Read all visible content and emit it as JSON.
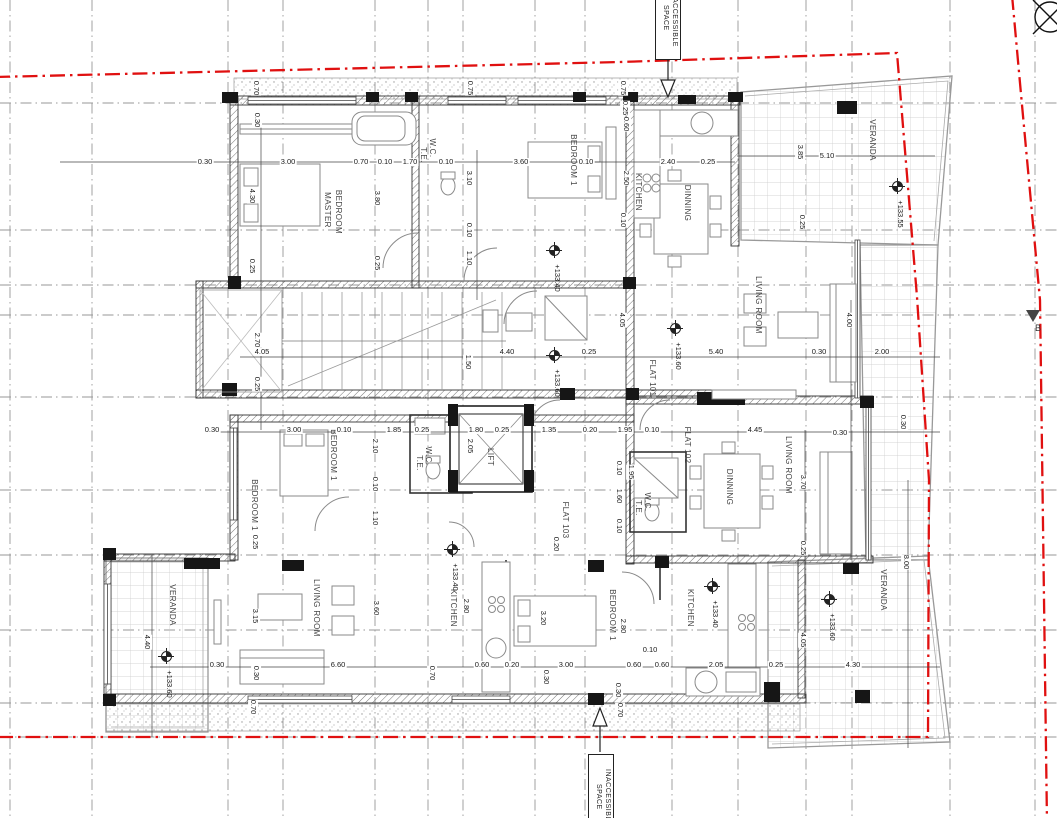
{
  "colors": {
    "boundary": "#e01010",
    "grid": "#979797",
    "ink": "#222222"
  },
  "markers": {
    "section": "B"
  },
  "inaccessible_space": {
    "top": "INACCESSIBLE SPACE",
    "bottom": "INACCESSIBLE SPACE"
  },
  "labels": {
    "rooms": [
      {
        "t": "MASTER",
        "x": 327,
        "y": 210,
        "v": true
      },
      {
        "t": "BEDROOM",
        "x": 338,
        "y": 212,
        "v": true
      },
      {
        "t": "W.C.",
        "x": 432,
        "y": 148,
        "v": true
      },
      {
        "t": "T.E.",
        "x": 423,
        "y": 155,
        "v": true
      },
      {
        "t": "BEDROOM 1",
        "x": 573,
        "y": 160,
        "v": true
      },
      {
        "t": "KITCHEN",
        "x": 638,
        "y": 192,
        "v": true
      },
      {
        "t": "DINNING",
        "x": 687,
        "y": 203,
        "v": true
      },
      {
        "t": "VERANDA",
        "x": 872,
        "y": 140,
        "v": true
      },
      {
        "t": "LIVING ROOM",
        "x": 758,
        "y": 305,
        "v": true
      },
      {
        "t": "LIVING ROOM",
        "x": 788,
        "y": 465,
        "v": true
      },
      {
        "t": "DINNING",
        "x": 729,
        "y": 487,
        "v": true
      },
      {
        "t": "W.C.",
        "x": 647,
        "y": 502,
        "v": true
      },
      {
        "t": "T.E.",
        "x": 638,
        "y": 508,
        "v": true
      },
      {
        "t": "BEDROOM 1",
        "x": 333,
        "y": 455,
        "v": true
      },
      {
        "t": "BEDROOM 1",
        "x": 254,
        "y": 505,
        "v": true
      },
      {
        "t": "W.C.",
        "x": 428,
        "y": 456,
        "v": true
      },
      {
        "t": "T.E.",
        "x": 419,
        "y": 463,
        "v": true
      },
      {
        "t": "LIFT",
        "x": 490,
        "y": 457,
        "v": true
      },
      {
        "t": "LIVING ROOM",
        "x": 316,
        "y": 608,
        "v": true
      },
      {
        "t": "KITCHEN",
        "x": 453,
        "y": 608,
        "v": true
      },
      {
        "t": "BEDROOM 1",
        "x": 612,
        "y": 615,
        "v": true
      },
      {
        "t": "KITCHEN",
        "x": 690,
        "y": 608,
        "v": true
      },
      {
        "t": "VERANDA",
        "x": 172,
        "y": 605,
        "v": true
      },
      {
        "t": "VERANDA",
        "x": 883,
        "y": 590,
        "v": true
      }
    ],
    "flats": [
      {
        "t": "FLAT 101",
        "x": 652,
        "y": 378,
        "v": true
      },
      {
        "t": "FLAT 102",
        "x": 687,
        "y": 445,
        "v": true
      },
      {
        "t": "FLAT 103",
        "x": 565,
        "y": 520,
        "v": true
      }
    ],
    "levels": [
      {
        "t": "+133.55",
        "x": 897,
        "y": 186
      },
      {
        "t": "+133.40",
        "x": 554,
        "y": 250
      },
      {
        "t": "+133.60",
        "x": 675,
        "y": 328
      },
      {
        "t": "+133.60",
        "x": 554,
        "y": 355
      },
      {
        "t": "+133.40",
        "x": 452,
        "y": 549
      },
      {
        "t": "+133.40",
        "x": 712,
        "y": 586
      },
      {
        "t": "+133.60",
        "x": 829,
        "y": 599
      },
      {
        "t": "+133.60",
        "x": 166,
        "y": 656
      }
    ],
    "dimensions": [
      {
        "t": "0.70",
        "x": 256,
        "y": 88,
        "v": true
      },
      {
        "t": "0.30",
        "x": 257,
        "y": 120,
        "v": true
      },
      {
        "t": "0.75",
        "x": 470,
        "y": 88,
        "v": true
      },
      {
        "t": "0.75",
        "x": 623,
        "y": 88,
        "v": true
      },
      {
        "t": "0.25",
        "x": 625,
        "y": 108,
        "v": true
      },
      {
        "t": "0.60",
        "x": 626,
        "y": 124,
        "v": true
      },
      {
        "t": "2.50",
        "x": 626,
        "y": 178,
        "v": true
      },
      {
        "t": "0.10",
        "x": 623,
        "y": 220,
        "v": true
      },
      {
        "t": "0.30",
        "x": 205,
        "y": 162
      },
      {
        "t": "3.00",
        "x": 288,
        "y": 162
      },
      {
        "t": "0.70",
        "x": 361,
        "y": 162
      },
      {
        "t": "0.10",
        "x": 385,
        "y": 162
      },
      {
        "t": "1.70",
        "x": 410,
        "y": 162
      },
      {
        "t": "0.10",
        "x": 446,
        "y": 162
      },
      {
        "t": "3.60",
        "x": 521,
        "y": 162
      },
      {
        "t": "0.10",
        "x": 586,
        "y": 162
      },
      {
        "t": "2.40",
        "x": 668,
        "y": 162
      },
      {
        "t": "0.25",
        "x": 708,
        "y": 162
      },
      {
        "t": "3.85",
        "x": 800,
        "y": 152,
        "v": true
      },
      {
        "t": "5.10",
        "x": 827,
        "y": 156
      },
      {
        "t": "0.25",
        "x": 802,
        "y": 222,
        "v": true
      },
      {
        "t": "4.30",
        "x": 252,
        "y": 196,
        "v": true
      },
      {
        "t": "0.25",
        "x": 252,
        "y": 266,
        "v": true
      },
      {
        "t": "3.80",
        "x": 377,
        "y": 198,
        "v": true
      },
      {
        "t": "0.25",
        "x": 377,
        "y": 263,
        "v": true
      },
      {
        "t": "3.10",
        "x": 469,
        "y": 178,
        "v": true
      },
      {
        "t": "0.10",
        "x": 469,
        "y": 230,
        "v": true
      },
      {
        "t": "1.10",
        "x": 469,
        "y": 258,
        "v": true
      },
      {
        "t": "2.70",
        "x": 257,
        "y": 340,
        "v": true
      },
      {
        "t": "0.25",
        "x": 257,
        "y": 384,
        "v": true
      },
      {
        "t": "4.05",
        "x": 262,
        "y": 352
      },
      {
        "t": "4.40",
        "x": 507,
        "y": 352
      },
      {
        "t": "0.25",
        "x": 589,
        "y": 352
      },
      {
        "t": "5.40",
        "x": 716,
        "y": 352
      },
      {
        "t": "0.30",
        "x": 819,
        "y": 352
      },
      {
        "t": "2.00",
        "x": 882,
        "y": 352
      },
      {
        "t": "4.00",
        "x": 849,
        "y": 320,
        "v": true
      },
      {
        "t": "4.05",
        "x": 622,
        "y": 320,
        "v": true
      },
      {
        "t": "1.50",
        "x": 468,
        "y": 362,
        "v": true
      },
      {
        "t": "0.30",
        "x": 212,
        "y": 430
      },
      {
        "t": "3.00",
        "x": 294,
        "y": 430
      },
      {
        "t": "0.10",
        "x": 344,
        "y": 430
      },
      {
        "t": "1.85",
        "x": 394,
        "y": 430
      },
      {
        "t": "0.25",
        "x": 422,
        "y": 430
      },
      {
        "t": "1.80",
        "x": 476,
        "y": 430
      },
      {
        "t": "0.25",
        "x": 502,
        "y": 430
      },
      {
        "t": "1.35",
        "x": 549,
        "y": 430
      },
      {
        "t": "0.20",
        "x": 590,
        "y": 430
      },
      {
        "t": "1.95",
        "x": 625,
        "y": 430
      },
      {
        "t": "0.10",
        "x": 652,
        "y": 430
      },
      {
        "t": "4.45",
        "x": 755,
        "y": 430
      },
      {
        "t": "0.30",
        "x": 840,
        "y": 433
      },
      {
        "t": "0.30",
        "x": 903,
        "y": 422,
        "v": true
      },
      {
        "t": "2.05",
        "x": 470,
        "y": 446,
        "v": true
      },
      {
        "t": "2.10",
        "x": 375,
        "y": 446,
        "v": true
      },
      {
        "t": "0.10",
        "x": 375,
        "y": 484,
        "v": true
      },
      {
        "t": "1.10",
        "x": 375,
        "y": 518,
        "v": true
      },
      {
        "t": "0.25",
        "x": 255,
        "y": 542,
        "v": true
      },
      {
        "t": "1.95",
        "x": 631,
        "y": 472,
        "v": true
      },
      {
        "t": "0.10",
        "x": 619,
        "y": 468,
        "v": true
      },
      {
        "t": "1.60",
        "x": 619,
        "y": 496,
        "v": true
      },
      {
        "t": "0.10",
        "x": 619,
        "y": 526,
        "v": true
      },
      {
        "t": "0.20",
        "x": 556,
        "y": 544,
        "v": true
      },
      {
        "t": "3.70",
        "x": 803,
        "y": 482,
        "v": true
      },
      {
        "t": "0.25",
        "x": 803,
        "y": 548,
        "v": true
      },
      {
        "t": "8.00",
        "x": 906,
        "y": 562,
        "v": true
      },
      {
        "t": "4.05",
        "x": 803,
        "y": 640,
        "v": true
      },
      {
        "t": "3.15",
        "x": 255,
        "y": 616,
        "v": true
      },
      {
        "t": "3.60",
        "x": 376,
        "y": 608,
        "v": true
      },
      {
        "t": "0.30",
        "x": 256,
        "y": 673,
        "v": true
      },
      {
        "t": "0.70",
        "x": 253,
        "y": 707,
        "v": true
      },
      {
        "t": "2.80",
        "x": 466,
        "y": 606,
        "v": true
      },
      {
        "t": "0.70",
        "x": 432,
        "y": 673,
        "v": true
      },
      {
        "t": "3.20",
        "x": 543,
        "y": 618,
        "v": true
      },
      {
        "t": "0.30",
        "x": 546,
        "y": 677,
        "v": true
      },
      {
        "t": "2.80",
        "x": 623,
        "y": 626,
        "v": true
      },
      {
        "t": "0.30",
        "x": 618,
        "y": 690,
        "v": true
      },
      {
        "t": "0.70",
        "x": 620,
        "y": 710,
        "v": true
      },
      {
        "t": "4.40",
        "x": 147,
        "y": 642,
        "v": true
      },
      {
        "t": "0.10",
        "x": 650,
        "y": 650
      },
      {
        "t": "0.30",
        "x": 217,
        "y": 665
      },
      {
        "t": "6.60",
        "x": 338,
        "y": 665
      },
      {
        "t": "0.60",
        "x": 482,
        "y": 665
      },
      {
        "t": "0.20",
        "x": 512,
        "y": 665
      },
      {
        "t": "3.00",
        "x": 566,
        "y": 665
      },
      {
        "t": "0.60",
        "x": 634,
        "y": 665
      },
      {
        "t": "0.60",
        "x": 662,
        "y": 665
      },
      {
        "t": "2.05",
        "x": 716,
        "y": 665
      },
      {
        "t": "0.25",
        "x": 776,
        "y": 665
      },
      {
        "t": "4.30",
        "x": 853,
        "y": 665
      }
    ]
  }
}
